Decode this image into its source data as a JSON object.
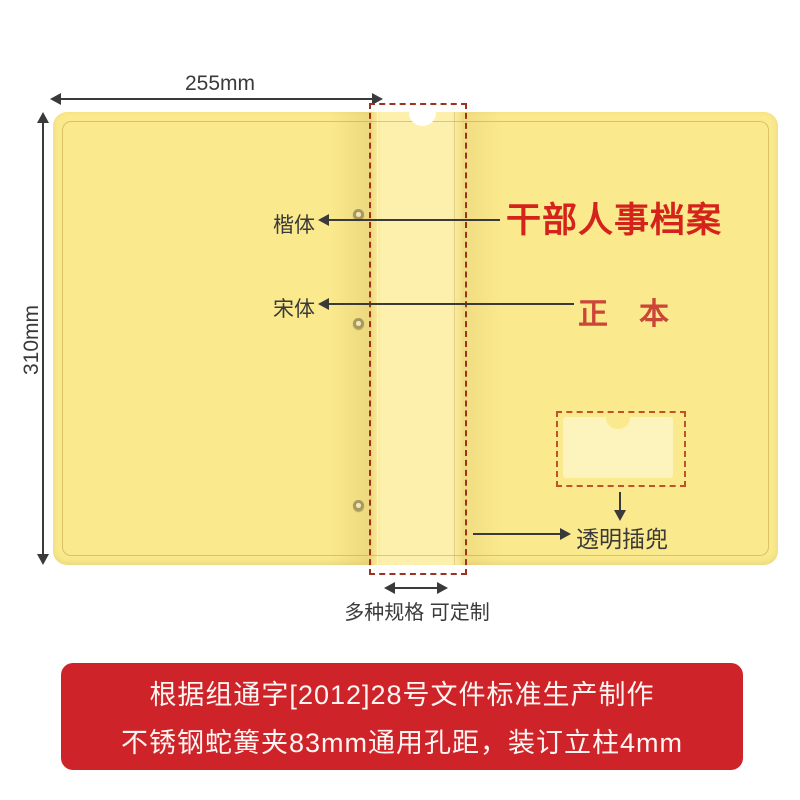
{
  "page": {
    "background": "#ffffff"
  },
  "colors": {
    "folder_body": "#fae98d",
    "folder_spine": "#fcf0ac",
    "pocket": "#fdf3bd",
    "spine_dash": "#9e3220",
    "pocket_dash": "#c0522a",
    "title_red": "#d3231a",
    "subtitle_red": "#cb4538",
    "banner_red": "#cf232a",
    "ink": "#3a3a3a"
  },
  "dimensions": {
    "width_label": "255mm",
    "height_label": "310mm"
  },
  "labels": {
    "kai_font": "楷体",
    "song_font": "宋体",
    "pocket": "透明插兜",
    "spec": "多种规格 可定制"
  },
  "cover_text": {
    "title": "干部人事档案",
    "subtitle": "正本"
  },
  "banner": {
    "line1": "根据组通字[2012]28号文件标准生产制作",
    "line2": "不锈钢蛇簧夹83mm通用孔距，装订立柱4mm"
  }
}
